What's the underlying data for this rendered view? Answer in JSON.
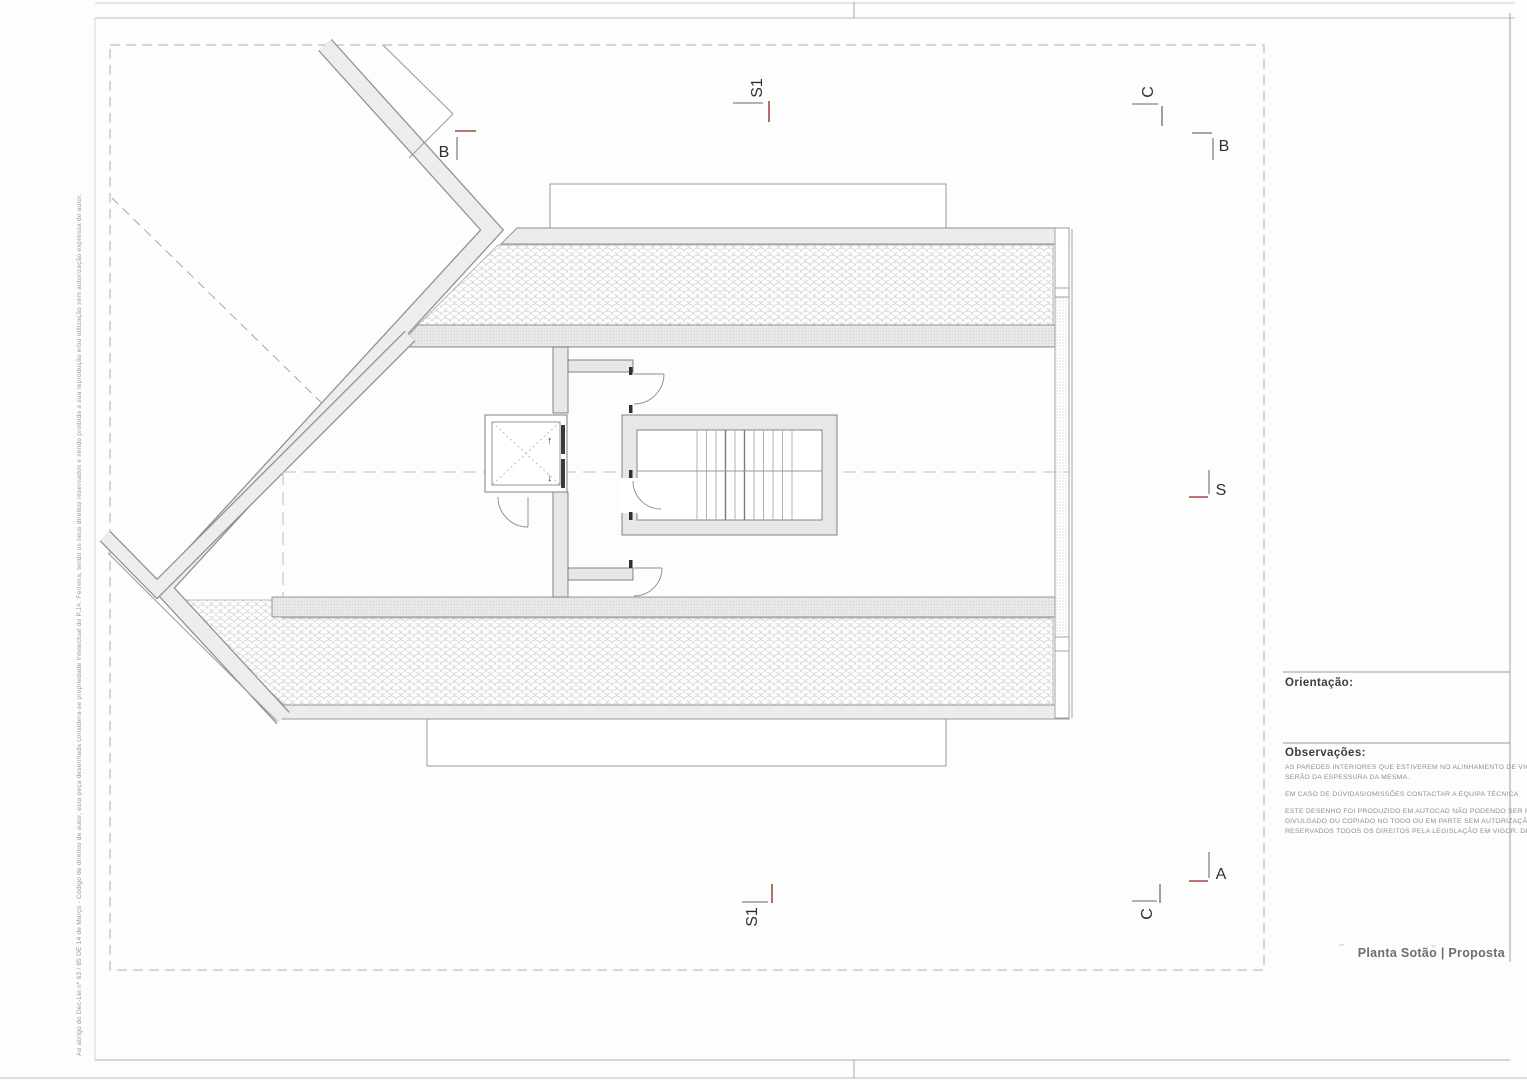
{
  "sheet": {
    "title": "Planta Sotão | Proposta",
    "copyright_vertical": "Ao abrigo do Dec-Lei nº 63 / 85 DE 14 de Março - Código de direitos de autor, esta peça desenhada considera-se propriedade intelectual do P.JA. Ferreira, tendo os seus direitos reservados e sendo proibida a sua reprodução e/ou utilização sem autorização expressa do autor."
  },
  "title_block": {
    "orientation_label": "Orientação:",
    "observations_label": "Observações:",
    "notes": [
      "AS PAREDES INTERIORES QUE ESTIVEREM NO ALINHAMENTO DE VIGAS",
      "SERÃO DA ESPESSURA DA MESMA.",
      "EM CASO DE DÚVIDAS/OMISSÕES CONTACTAR A EQUIPA TÉCNICA",
      "ESTE DESENHO FOI PRODUZIDO EM AUTOCAD NÃO PODENDO SER REPRODUZIDO,",
      "DIVULGADO OU COPIADO NO TODO OU EM PARTE SEM AUTORIZAÇÃO EXPRESSA.",
      "RESERVADOS TODOS OS DIREITOS PELA LEGISLAÇÃO EM VIGOR. DEC. LEI 63/85"
    ]
  },
  "section_markers": {
    "b_left": "B",
    "s1_top": "S1",
    "c_top": "C",
    "b_right": "B",
    "s_right": "S",
    "a_right": "A",
    "c_bottom": "C",
    "s1_bottom": "S1"
  },
  "plan": {
    "elevator_up_icon": "↑",
    "elevator_down_icon": "↓"
  },
  "colors": {
    "section_tick_red": "#a04a42",
    "section_tick_brown": "#9a8080",
    "section_tick_gray": "#9a9a9a"
  }
}
